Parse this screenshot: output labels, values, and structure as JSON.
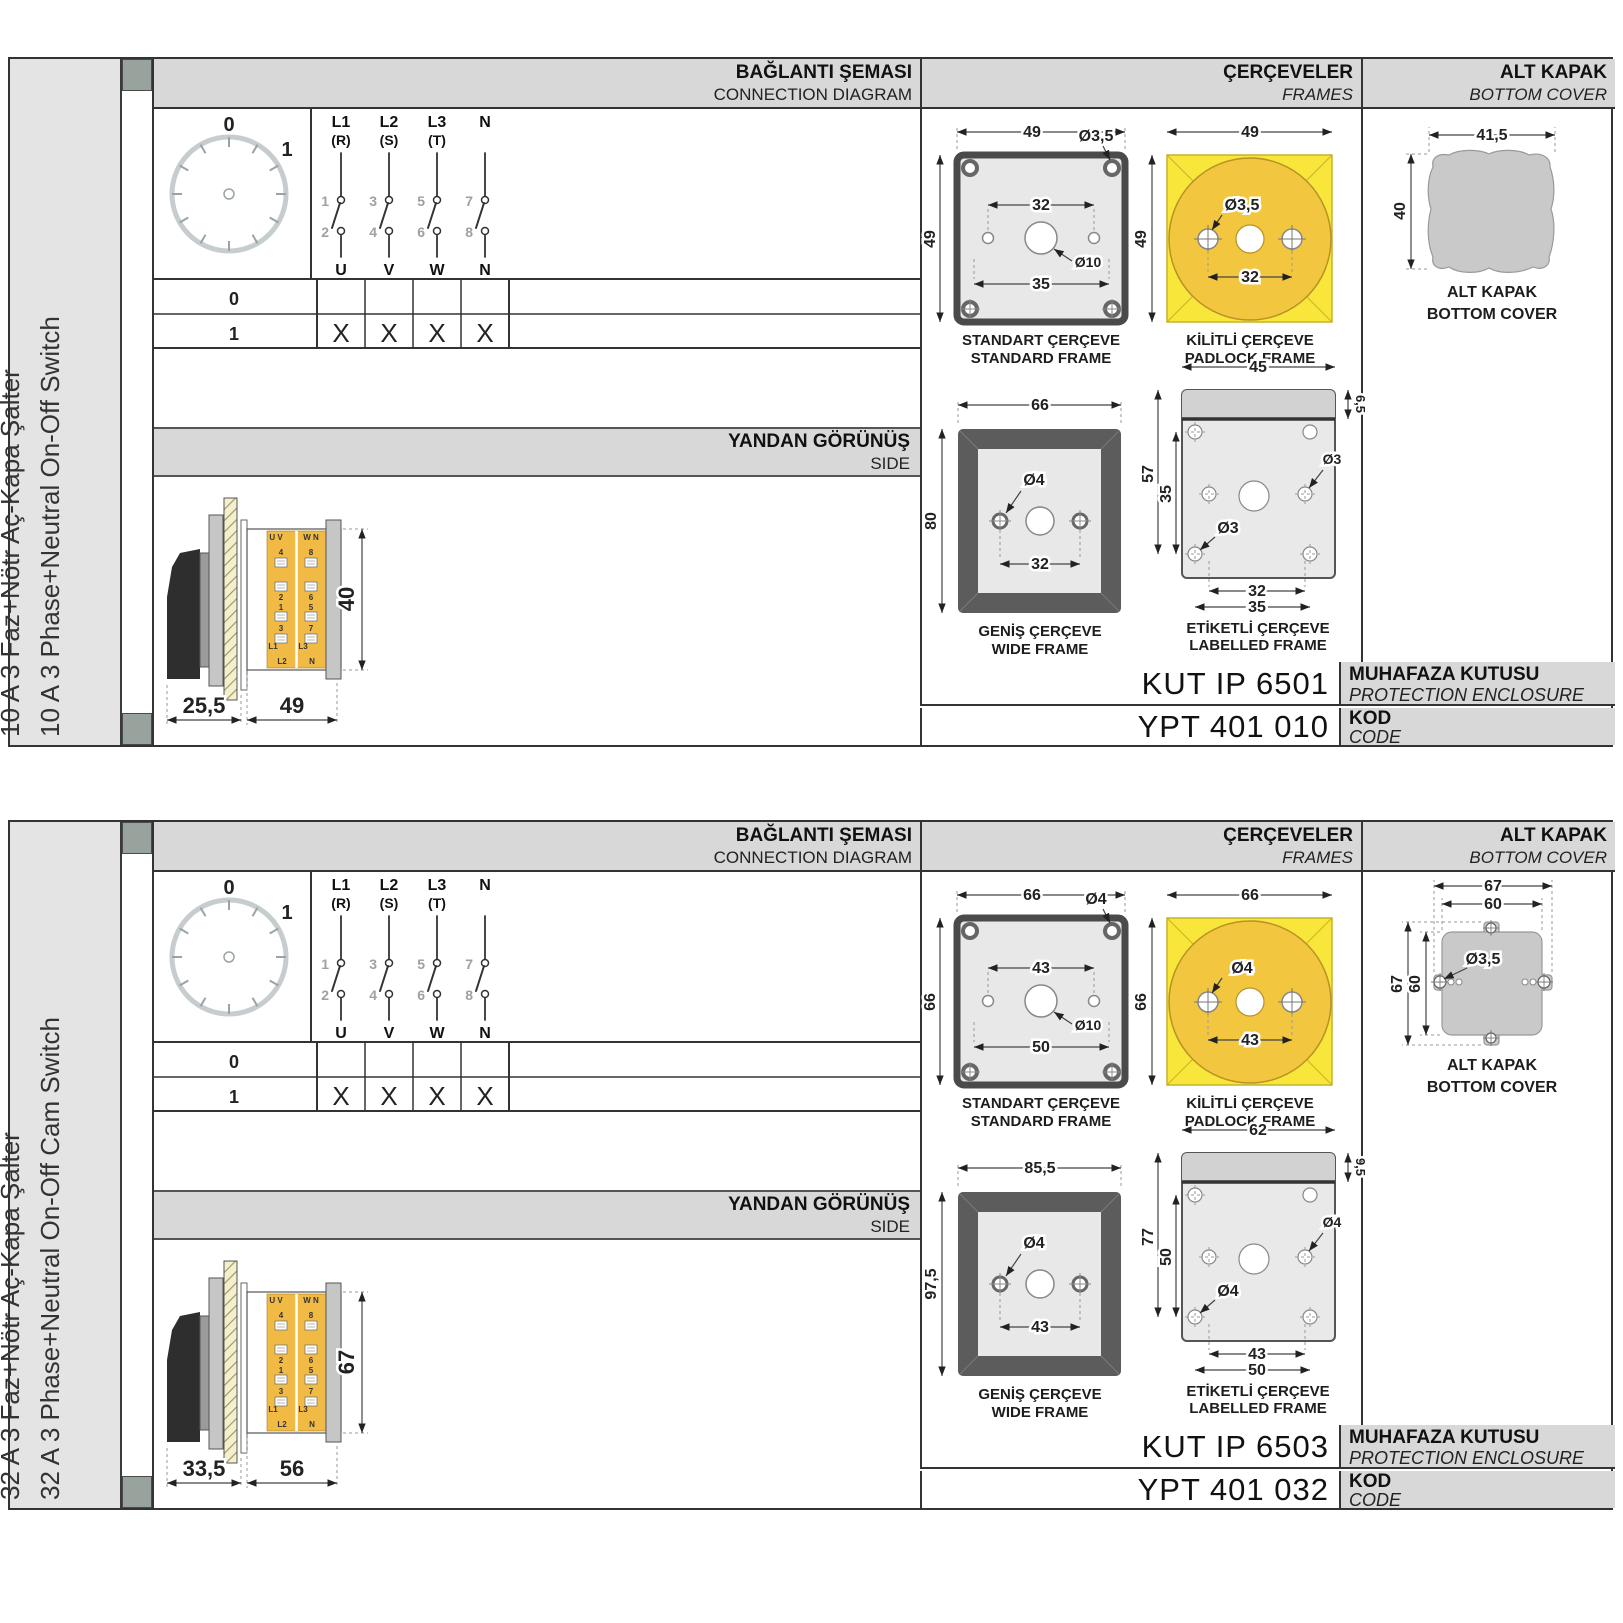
{
  "labels": {
    "conn_title": "BAĞLANTI ŞEMASI",
    "conn_sub": "CONNECTION DIAGRAM",
    "frames_title": "ÇERÇEVELER",
    "frames_sub": "FRAMES",
    "cover_title": "ALT KAPAK",
    "cover_sub": "BOTTOM COVER",
    "side_title": "YANDAN GÖRÜNÜŞ",
    "side_sub": "SIDE",
    "enclosure_label": "MUHAFAZA KUTUSU",
    "enclosure_sub": "PROTECTION ENCLOSURE",
    "code_label": "KOD",
    "code_sub": "CODE",
    "standard_frame_tr": "STANDART ÇERÇEVE",
    "standard_frame_en": "STANDARD FRAME",
    "padlock_frame_tr": "KİLİTLİ ÇERÇEVE",
    "padlock_frame_en": "PADLOCK FRAME",
    "wide_frame_tr": "GENİŞ ÇERÇEVE",
    "wide_frame_en": "WIDE FRAME",
    "labelled_frame_tr": "ETİKETLİ ÇERÇEVE",
    "labelled_frame_en": "LABELLED FRAME",
    "cover_caption_tr": "ALT KAPAK",
    "cover_caption_en": "BOTTOM COVER"
  },
  "colors": {
    "frame_yellow": "#f8e63a",
    "padlock_gold": "#f2c63e",
    "body_yellow": "#f0ba45",
    "panel_gray": "#e4e4e4",
    "header_gray": "#d8d8d8",
    "dark_frame": "#5c5c5c"
  },
  "sections": [
    {
      "cover_type": "blob",
      "sidebar": {
        "title_tr": "10 A 3 Faz+Nötr Aç-Kapa Şalter",
        "title_en": "10 A 3 Phase+Neutral On-Off Switch"
      },
      "connection": {
        "dial": {
          "positions": [
            "0",
            "1"
          ]
        },
        "phases": [
          {
            "l": "L1",
            "s": "(R)",
            "top": "1",
            "bot": "2",
            "out": "U"
          },
          {
            "l": "L2",
            "s": "(S)",
            "top": "3",
            "bot": "4",
            "out": "V"
          },
          {
            "l": "L3",
            "s": "(T)",
            "top": "5",
            "bot": "6",
            "out": "W"
          },
          {
            "l": "N",
            "s": "",
            "top": "7",
            "bot": "8",
            "out": "N"
          }
        ],
        "table": {
          "rows": [
            {
              "pos": "0",
              "marks": [
                "",
                "",
                "",
                ""
              ]
            },
            {
              "pos": "1",
              "marks": [
                "X",
                "X",
                "X",
                "X"
              ]
            }
          ]
        }
      },
      "side_view": {
        "dims": {
          "depth": "25,5",
          "width": "49",
          "height": "40"
        },
        "col1": {
          "top": "U V",
          "n1": "4",
          "n2": "2",
          "n3": "1",
          "n4": "3",
          "b1": "L1",
          "b2": "L2"
        },
        "col2": {
          "top": "W N",
          "n1": "8",
          "n2": "6",
          "n3": "5",
          "n4": "7",
          "b1": "L3",
          "b2": "N"
        }
      },
      "frames": {
        "standard": {
          "w": "49",
          "h": "49",
          "hole": "Ø3,5",
          "span": "32",
          "center": "Ø10",
          "base": "35"
        },
        "padlock": {
          "w": "49",
          "h": "49",
          "hole": "Ø3,5",
          "span": "32"
        },
        "wide": {
          "w": "66",
          "h": "80",
          "hole": "Ø4",
          "span": "32"
        },
        "labelled": {
          "w": "45",
          "tab": "6,5",
          "h": "57",
          "inner": "35",
          "hole_a": "Ø3",
          "hole_b": "Ø3",
          "span_a": "32",
          "span_b": "35"
        }
      },
      "cover": {
        "w": "41,5",
        "h": "40"
      },
      "codes": {
        "enclosure": "KUT IP 6501",
        "code": "YPT 401 010"
      }
    },
    {
      "cover_type": "tabbed",
      "sidebar": {
        "title_tr": "32 A 3 Faz+Nötr Aç-Kapa Şalter",
        "title_en": "32 A 3 Phase+Neutral On-Off Cam Switch"
      },
      "connection": {
        "dial": {
          "positions": [
            "0",
            "1"
          ]
        },
        "phases": [
          {
            "l": "L1",
            "s": "(R)",
            "top": "1",
            "bot": "2",
            "out": "U"
          },
          {
            "l": "L2",
            "s": "(S)",
            "top": "3",
            "bot": "4",
            "out": "V"
          },
          {
            "l": "L3",
            "s": "(T)",
            "top": "5",
            "bot": "6",
            "out": "W"
          },
          {
            "l": "N",
            "s": "",
            "top": "7",
            "bot": "8",
            "out": "N"
          }
        ],
        "table": {
          "rows": [
            {
              "pos": "0",
              "marks": [
                "",
                "",
                "",
                ""
              ]
            },
            {
              "pos": "1",
              "marks": [
                "X",
                "X",
                "X",
                "X"
              ]
            }
          ]
        }
      },
      "side_view": {
        "dims": {
          "depth": "33,5",
          "width": "56",
          "height": "67"
        },
        "col1": {
          "top": "U V",
          "n1": "4",
          "n2": "2",
          "n3": "1",
          "n4": "3",
          "b1": "L1",
          "b2": "L2"
        },
        "col2": {
          "top": "W N",
          "n1": "8",
          "n2": "6",
          "n3": "5",
          "n4": "7",
          "b1": "L3",
          "b2": "N"
        }
      },
      "frames": {
        "standard": {
          "w": "66",
          "h": "66",
          "hole": "Ø4",
          "span": "43",
          "center": "Ø10",
          "base": "50"
        },
        "padlock": {
          "w": "66",
          "h": "66",
          "hole": "Ø4",
          "span": "43"
        },
        "wide": {
          "w": "85,5",
          "h": "97,5",
          "hole": "Ø4",
          "span": "43"
        },
        "labelled": {
          "w": "62",
          "tab": "9,5",
          "h": "77",
          "inner": "50",
          "hole_a": "Ø4",
          "hole_b": "Ø4",
          "span_a": "43",
          "span_b": "50"
        }
      },
      "cover": {
        "w1": "67",
        "w2": "60",
        "h1": "67",
        "h2": "60",
        "hole": "Ø3,5"
      },
      "codes": {
        "enclosure": "KUT IP 6503",
        "code": "YPT 401 032"
      }
    }
  ]
}
